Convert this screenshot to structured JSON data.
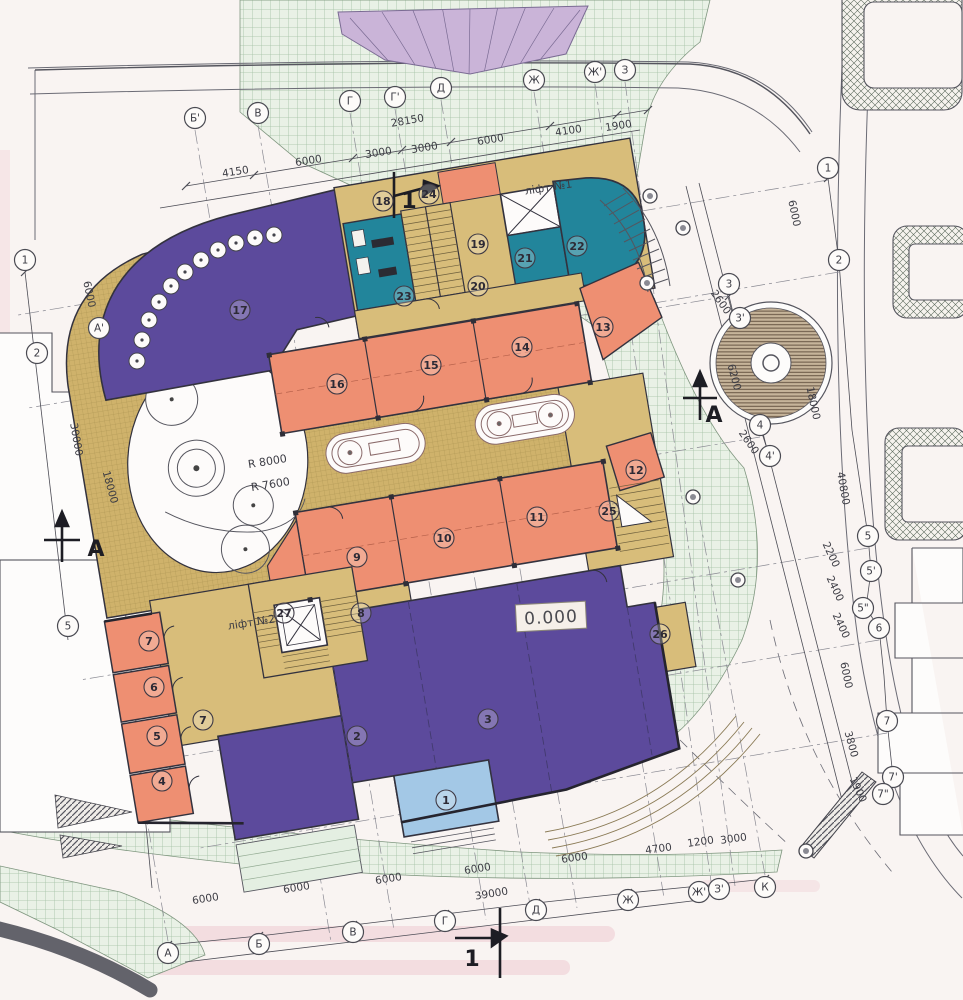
{
  "drawing": {
    "type": "architectural site / ground floor plan",
    "colors": {
      "purple_rooms": "#5c4a9c",
      "orange_rooms": "#ee8f72",
      "khaki_terrace": "#cfb26b",
      "khaki_rooms": "#d8bd7a",
      "teal_rooms": "#22859b",
      "lightblue_room": "#a3c8e6",
      "plaza_green": "#e9f1e6",
      "walls": "#33323e"
    }
  },
  "elevation": {
    "value": "0.000"
  },
  "labels": [
    {
      "name": "lift-1-label",
      "text": "ліфт №1",
      "x": 549,
      "y": 191,
      "size": 11,
      "rot": -9
    },
    {
      "name": "lift-2-label",
      "text": "ліфт №2",
      "x": 252,
      "y": 626,
      "size": 11,
      "rot": -9
    },
    {
      "name": "radius-8000-label",
      "text": "R 8000",
      "x": 268,
      "y": 465,
      "size": 12,
      "rot": -9
    },
    {
      "name": "radius-7600-label",
      "text": "R 7600",
      "x": 271,
      "y": 488,
      "size": 12,
      "rot": -9
    }
  ],
  "section_marks": [
    {
      "text": "1",
      "x": 409,
      "y": 208
    },
    {
      "text": "1",
      "x": 472,
      "y": 966
    },
    {
      "text": "А",
      "x": 96,
      "y": 556
    },
    {
      "text": "А",
      "x": 714,
      "y": 422
    }
  ],
  "axis_bubbles": [
    {
      "label": "Б'",
      "x": 195,
      "y": 118
    },
    {
      "label": "В",
      "x": 258,
      "y": 113
    },
    {
      "label": "Г",
      "x": 350,
      "y": 101
    },
    {
      "label": "Г'",
      "x": 395,
      "y": 97
    },
    {
      "label": "Д",
      "x": 441,
      "y": 88
    },
    {
      "label": "Ж",
      "x": 534,
      "y": 80
    },
    {
      "label": "Ж'",
      "x": 595,
      "y": 72
    },
    {
      "label": "З",
      "x": 625,
      "y": 70
    },
    {
      "label": "1",
      "x": 828,
      "y": 168
    },
    {
      "label": "2",
      "x": 839,
      "y": 260
    },
    {
      "label": "3",
      "x": 729,
      "y": 284
    },
    {
      "label": "3'",
      "x": 740,
      "y": 318
    },
    {
      "label": "4",
      "x": 760,
      "y": 425
    },
    {
      "label": "4'",
      "x": 770,
      "y": 456
    },
    {
      "label": "5",
      "x": 868,
      "y": 536
    },
    {
      "label": "5'",
      "x": 871,
      "y": 571
    },
    {
      "label": "5\"",
      "x": 863,
      "y": 608
    },
    {
      "label": "6",
      "x": 879,
      "y": 628
    },
    {
      "label": "7",
      "x": 887,
      "y": 721
    },
    {
      "label": "7'",
      "x": 893,
      "y": 777
    },
    {
      "label": "7\"",
      "x": 883,
      "y": 794
    },
    {
      "label": "1",
      "x": 25,
      "y": 260
    },
    {
      "label": "А'",
      "x": 99,
      "y": 328
    },
    {
      "label": "2",
      "x": 37,
      "y": 353
    },
    {
      "label": "5",
      "x": 68,
      "y": 626
    },
    {
      "label": "А",
      "x": 168,
      "y": 953
    },
    {
      "label": "Б",
      "x": 259,
      "y": 944
    },
    {
      "label": "В",
      "x": 353,
      "y": 932
    },
    {
      "label": "Г",
      "x": 445,
      "y": 921
    },
    {
      "label": "Д",
      "x": 536,
      "y": 910
    },
    {
      "label": "Ж",
      "x": 628,
      "y": 900
    },
    {
      "label": "Ж'",
      "x": 699,
      "y": 892
    },
    {
      "label": "З'",
      "x": 719,
      "y": 889
    },
    {
      "label": "К",
      "x": 765,
      "y": 887
    }
  ],
  "room_numbers": [
    {
      "n": "1",
      "x": 446,
      "y": 800
    },
    {
      "n": "2",
      "x": 357,
      "y": 736
    },
    {
      "n": "3",
      "x": 488,
      "y": 719
    },
    {
      "n": "4",
      "x": 162,
      "y": 781
    },
    {
      "n": "5",
      "x": 157,
      "y": 736
    },
    {
      "n": "6",
      "x": 154,
      "y": 687
    },
    {
      "n": "7",
      "x": 149,
      "y": 641
    },
    {
      "n": "7",
      "x": 203,
      "y": 720
    },
    {
      "n": "8",
      "x": 361,
      "y": 613
    },
    {
      "n": "9",
      "x": 357,
      "y": 557
    },
    {
      "n": "10",
      "x": 444,
      "y": 538
    },
    {
      "n": "11",
      "x": 537,
      "y": 517
    },
    {
      "n": "12",
      "x": 636,
      "y": 470
    },
    {
      "n": "13",
      "x": 603,
      "y": 327
    },
    {
      "n": "14",
      "x": 522,
      "y": 347
    },
    {
      "n": "15",
      "x": 431,
      "y": 365
    },
    {
      "n": "16",
      "x": 337,
      "y": 384
    },
    {
      "n": "17",
      "x": 240,
      "y": 310
    },
    {
      "n": "18",
      "x": 383,
      "y": 201
    },
    {
      "n": "19",
      "x": 478,
      "y": 244
    },
    {
      "n": "20",
      "x": 478,
      "y": 286
    },
    {
      "n": "21",
      "x": 525,
      "y": 258
    },
    {
      "n": "22",
      "x": 577,
      "y": 246
    },
    {
      "n": "23",
      "x": 404,
      "y": 296
    },
    {
      "n": "24",
      "x": 429,
      "y": 194
    },
    {
      "n": "25",
      "x": 609,
      "y": 511
    },
    {
      "n": "26",
      "x": 660,
      "y": 634
    },
    {
      "n": "27",
      "x": 284,
      "y": 613
    }
  ],
  "dimensions": [
    {
      "text": "28150",
      "x": 408,
      "y": 124,
      "rot": -10
    },
    {
      "text": "4150",
      "x": 236,
      "y": 175,
      "rot": -9
    },
    {
      "text": "6000",
      "x": 309,
      "y": 164,
      "rot": -9
    },
    {
      "text": "3000",
      "x": 379,
      "y": 156,
      "rot": -9
    },
    {
      "text": "3000",
      "x": 425,
      "y": 151,
      "rot": -9
    },
    {
      "text": "6000",
      "x": 491,
      "y": 143,
      "rot": -9
    },
    {
      "text": "4100",
      "x": 569,
      "y": 134,
      "rot": -9
    },
    {
      "text": "1900",
      "x": 619,
      "y": 129,
      "rot": -9
    },
    {
      "text": "6000",
      "x": 86,
      "y": 295,
      "rot": 78
    },
    {
      "text": "30000",
      "x": 73,
      "y": 440,
      "rot": 80
    },
    {
      "text": "18000",
      "x": 107,
      "y": 488,
      "rot": 75
    },
    {
      "text": "6000",
      "x": 791,
      "y": 214,
      "rot": 78
    },
    {
      "text": "2600",
      "x": 718,
      "y": 304,
      "rot": 55
    },
    {
      "text": "6200",
      "x": 731,
      "y": 378,
      "rot": 75
    },
    {
      "text": "18000",
      "x": 810,
      "y": 404,
      "rot": 78
    },
    {
      "text": "2600",
      "x": 746,
      "y": 444,
      "rot": 55
    },
    {
      "text": "40800",
      "x": 840,
      "y": 489,
      "rot": 80
    },
    {
      "text": "2200",
      "x": 828,
      "y": 556,
      "rot": 65
    },
    {
      "text": "2400",
      "x": 832,
      "y": 590,
      "rot": 65
    },
    {
      "text": "2400",
      "x": 838,
      "y": 627,
      "rot": 65
    },
    {
      "text": "6000",
      "x": 843,
      "y": 676,
      "rot": 78
    },
    {
      "text": "3800",
      "x": 848,
      "y": 745,
      "rot": 75
    },
    {
      "text": "1900",
      "x": 855,
      "y": 791,
      "rot": 65
    },
    {
      "text": "6000",
      "x": 206,
      "y": 902,
      "rot": -9
    },
    {
      "text": "6000",
      "x": 297,
      "y": 891,
      "rot": -9
    },
    {
      "text": "6000",
      "x": 389,
      "y": 882,
      "rot": -9
    },
    {
      "text": "6000",
      "x": 478,
      "y": 872,
      "rot": -9
    },
    {
      "text": "39000",
      "x": 492,
      "y": 897,
      "rot": -9
    },
    {
      "text": "6000",
      "x": 575,
      "y": 861,
      "rot": -8
    },
    {
      "text": "4700",
      "x": 659,
      "y": 852,
      "rot": -8
    },
    {
      "text": "1200",
      "x": 701,
      "y": 845,
      "rot": -8
    },
    {
      "text": "3000",
      "x": 734,
      "y": 842,
      "rot": -8
    }
  ],
  "site": {
    "trees": [
      {
        "x": 137,
        "y": 361,
        "r": 8
      },
      {
        "x": 142,
        "y": 340,
        "r": 8
      },
      {
        "x": 149,
        "y": 320,
        "r": 8
      },
      {
        "x": 159,
        "y": 302,
        "r": 8
      },
      {
        "x": 171,
        "y": 286,
        "r": 8
      },
      {
        "x": 185,
        "y": 272,
        "r": 8
      },
      {
        "x": 201,
        "y": 260,
        "r": 8
      },
      {
        "x": 218,
        "y": 250,
        "r": 8
      },
      {
        "x": 236,
        "y": 243,
        "r": 8
      },
      {
        "x": 255,
        "y": 238,
        "r": 8
      },
      {
        "x": 274,
        "y": 235,
        "r": 8
      }
    ],
    "lamps": [
      {
        "x": 650,
        "y": 196
      },
      {
        "x": 683,
        "y": 228
      },
      {
        "x": 647,
        "y": 283
      },
      {
        "x": 693,
        "y": 497
      },
      {
        "x": 738,
        "y": 580
      },
      {
        "x": 806,
        "y": 851
      }
    ]
  }
}
